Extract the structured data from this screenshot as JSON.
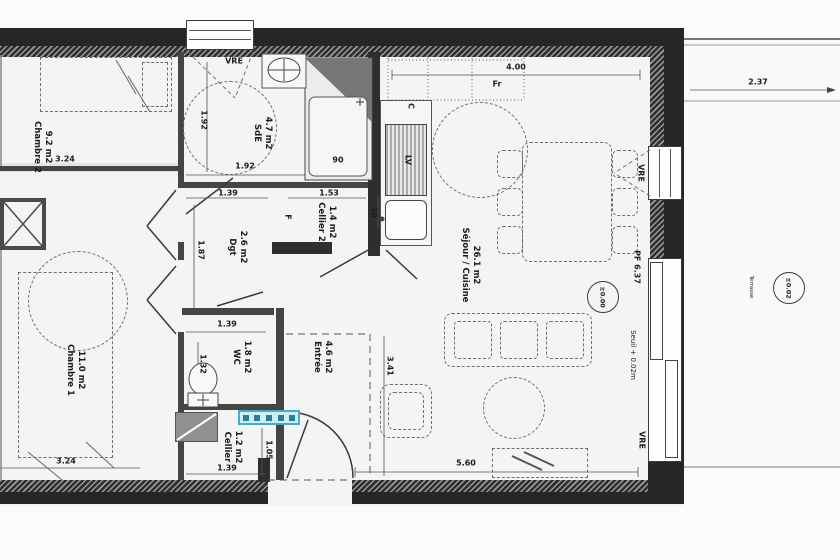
{
  "plan": {
    "rooms": {
      "chambre2": {
        "area": "9.2 m2",
        "name": "Chambre 2"
      },
      "sde": {
        "area": "4.7 m2",
        "name": "SdE"
      },
      "cellier2": {
        "area": "1.4 m2",
        "name": "Cellier 2"
      },
      "dgt": {
        "area": "2.6 m2",
        "name": "Dgt"
      },
      "chambre1": {
        "area": "11.0 m2",
        "name": "Chambre 1"
      },
      "wc": {
        "area": "1.8 m2",
        "name": "WC"
      },
      "cellier": {
        "area": "1.2 m2",
        "name": "Cellier"
      },
      "entree": {
        "area": "4.6 m2",
        "name": "Entrée"
      },
      "sejour": {
        "area": "26.1 m2",
        "name": "Séjour / Cuisine"
      }
    },
    "dims": {
      "chambre2_width": "3.24",
      "sde_height": "1.92",
      "sde_width": "1.92",
      "shower_size": "90",
      "dgt_width": "1.39",
      "cellier2_width": "1.53",
      "wall_thickness": "30",
      "dgt_height": "1.87",
      "sejour_top_width": "4.00",
      "terrace_width": "2.37",
      "wc_width": "1.39",
      "wc_height": "1.32",
      "entree_height": "3.41",
      "cellier_height": "1.05",
      "cellier_width": "1.39",
      "chambre1_width": "3.24",
      "sejour_bottom_width": "5.60",
      "window_right_label": "PF 6.37"
    },
    "labels": {
      "window_top": "VRE",
      "window_right_upper": "VRE",
      "window_right_lower": "VRE",
      "fridge": "Fr",
      "cooker": "C",
      "dishwasher": "LV",
      "freezer": "F",
      "terrace": "Terrasse",
      "threshold": "Seuil + 0.02m",
      "level_interior": "±0.00",
      "level_terrace": "±0.02"
    },
    "colors": {
      "wall": "#262624",
      "line": "#3c3c3c",
      "accent_cyan": "#cdeef4",
      "accent_cyan_border": "#45aec6",
      "paper": "#f4f4f2"
    }
  }
}
